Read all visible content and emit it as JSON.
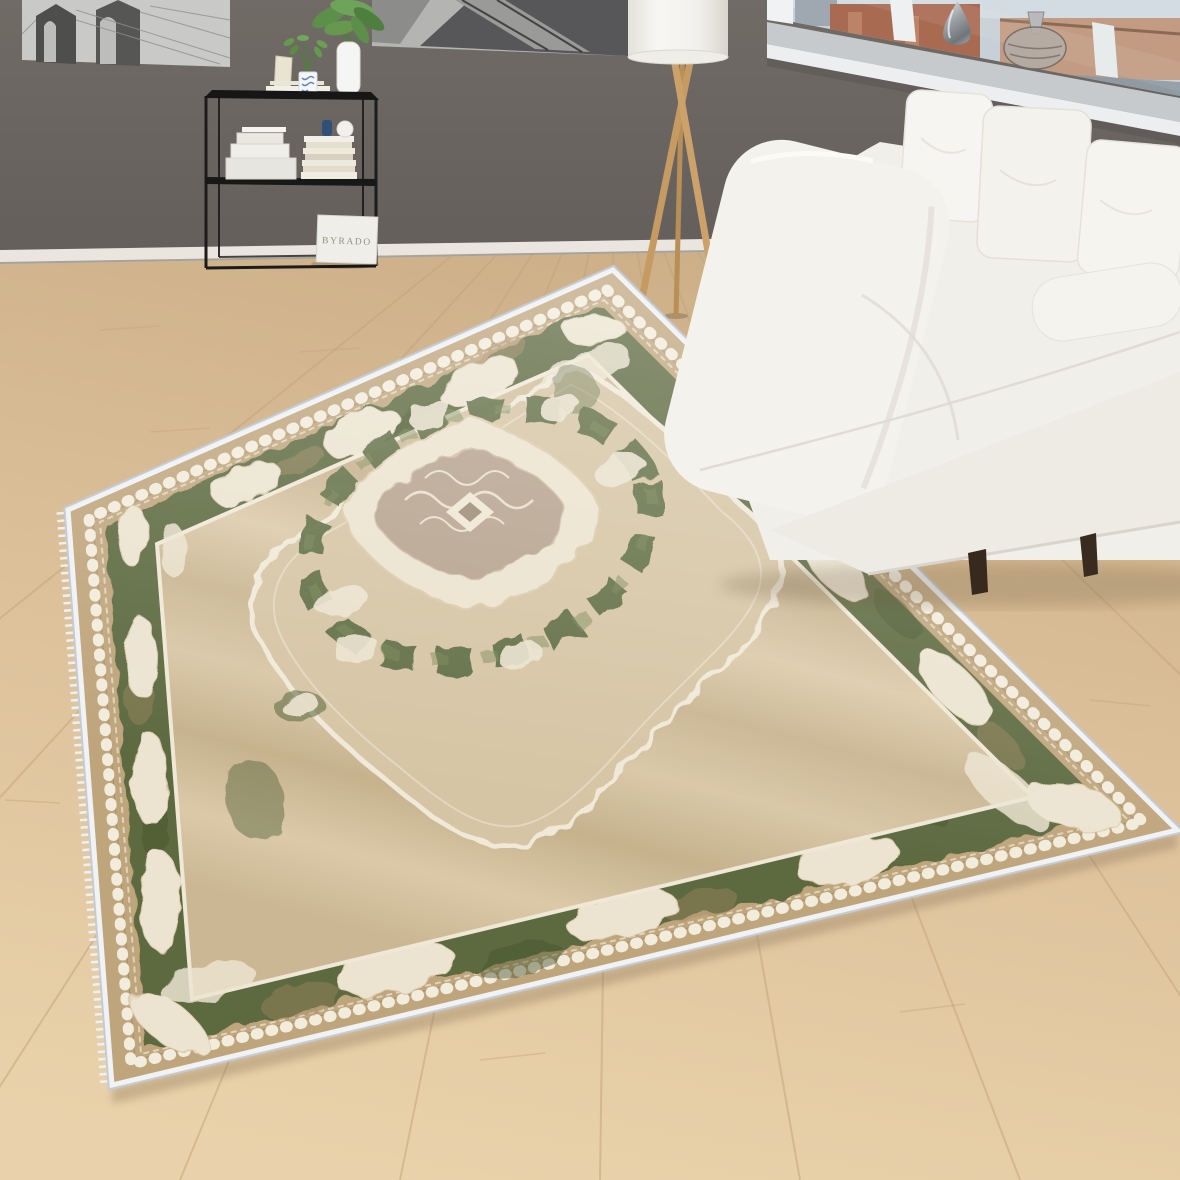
{
  "scene": {
    "setting": "Living room product photograph of an ornamental oriental rug on a light oak floor, with a white sofa, tripod floor lamp, black metal console shelf, two black-and-white wall pictures and a city-view window",
    "bag_label": "BYRADO",
    "rug": {
      "style": "oriental medallion rug with cream lace border on green and beige ground",
      "colors": {
        "binding": "#eef0f3",
        "outer_band": "#bfa57c",
        "border_green": "#5d6a41",
        "lace_cream": "#ece4d0",
        "field_beige": "#d2c09e",
        "medallion_core": "#b7a38e"
      }
    },
    "sofa": {
      "color": "#f2f0ea",
      "leg_color": "#3a2d23",
      "pillow_count": 3
    },
    "lamp": {
      "wood_color": "#c59b63",
      "shade_color": "#f6f5f1"
    },
    "shelf": {
      "frame_color": "#1d1d1d"
    },
    "wall": {
      "color": "#6c6662",
      "baseboard_color": "#eae6df"
    },
    "floor": {
      "color": "#ddc29c",
      "seam_color": "#c3a67e"
    },
    "window": {
      "sill_color": "#c7cbce",
      "frame_color": "#eef0f1",
      "city_colors": [
        "#a96a52",
        "#c39b82",
        "#8f9aa2"
      ]
    },
    "pictures": {
      "left_subject": "black and white bridge photograph",
      "right_subject": "black and white railway photograph"
    }
  }
}
